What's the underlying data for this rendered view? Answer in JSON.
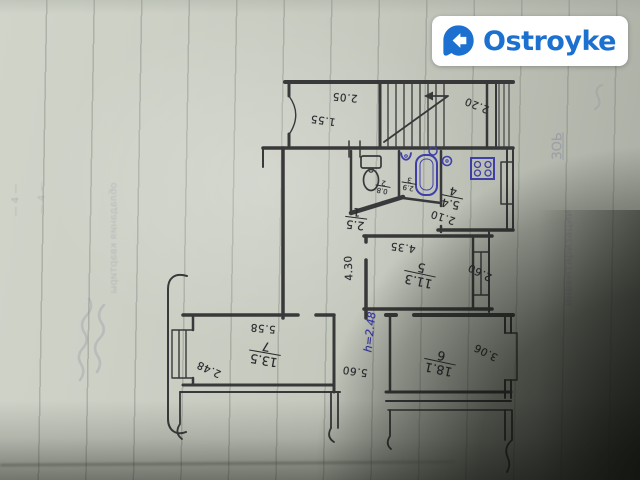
{
  "logo": {
    "text": "Ostroyke",
    "brand_color": "#1c70cf",
    "bg": "#ffffff",
    "icon": "home-bubble-icon"
  },
  "plan": {
    "ink": "#2e2e30",
    "blue_ink": "#3636a6",
    "rooms": [
      {
        "number": "1",
        "area": "2.5",
        "name": "hallway"
      },
      {
        "number": "2",
        "area": "0.8",
        "name": "wc"
      },
      {
        "number": "3",
        "area": "2.9",
        "name": "bathroom"
      },
      {
        "number": "4",
        "area": "5.4",
        "name": "kitchen"
      },
      {
        "number": "5",
        "area": "11.3",
        "name": "room"
      },
      {
        "number": "6",
        "area": "18.1",
        "name": "room"
      },
      {
        "number": "7",
        "area": "13.5",
        "name": "room"
      }
    ],
    "dims": {
      "loggia_a": "2.05",
      "loggia_b": "1.55",
      "stairs": "2.20",
      "kitchen_w": "2.10",
      "room5_w": "4.35",
      "hall_l": "4.30",
      "room5_d": "2.60",
      "room6_d": "3.06",
      "room6_w": "5.60",
      "room7_w": "5.58",
      "room7_d": "2.48"
    },
    "notes": {
      "height_note": "h=2.48"
    }
  },
  "paper": {
    "bleedthrough": [
      "— 4 —",
      "— 4 —",
      "обладания квартиры",
      "инвентаризации",
      "ЗОЬ"
    ]
  }
}
